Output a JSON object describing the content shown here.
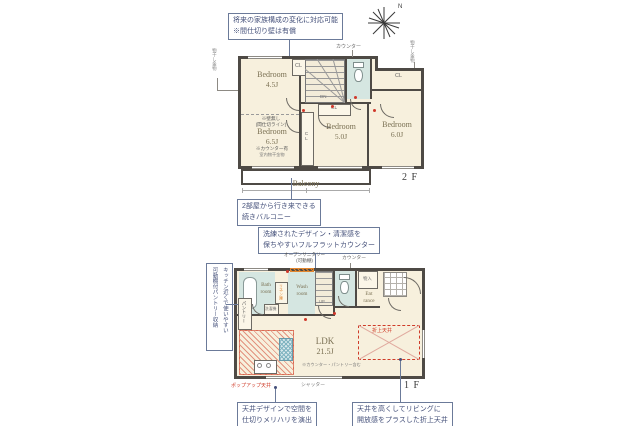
{
  "annotations": {
    "future_note": {
      "line1": "将来の家族構成の変化に対応可能",
      "line2": "※間仕切り壁は有償"
    },
    "balcony_note": {
      "line1": "2部屋から行き来できる",
      "line2": "続きバルコニー"
    },
    "counter_note": {
      "line1": "洗練されたデザイン・清潔感を",
      "line2": "保ちやすいフルフラットカウンター"
    },
    "pantry_note": {
      "line1": "キッチン近くで使いやすい",
      "line2": "可動棚付パントリー収納"
    },
    "ceiling_zone_note": {
      "line1": "天井デザインで空間を",
      "line2": "仕切りメリハリを演出"
    },
    "raised_ceiling_note": {
      "line1": "天井を高くしてリビングに",
      "line2": "開放感をプラスした折上天井"
    }
  },
  "compass": {
    "north": "N"
  },
  "floor2": {
    "label": "2 F",
    "bedroom_45": {
      "name": "Bedroom",
      "size": "4.5J"
    },
    "partition_note": {
      "line1": "※壁無し",
      "line2": "(間仕切ライン)"
    },
    "bedroom_65": {
      "name": "Bedroom",
      "size": "6.5J",
      "counter_note": "※カウンター有",
      "hoshi_note": "室内物干金物"
    },
    "bedroom_50": {
      "name": "Bedroom",
      "size": "5.0J"
    },
    "bedroom_60": {
      "name": "Bedroom",
      "size": "6.0J"
    },
    "balcony": "Balcony",
    "counter_label": "カウンター",
    "cl": "CL",
    "dn": "DN",
    "laundry_left": "物干し金物",
    "laundry_right": "物干し金物"
  },
  "floor1": {
    "label": "1 F",
    "bath": {
      "line1": "Bath",
      "line2": "room"
    },
    "wash": {
      "line1": "Wash",
      "line2": "room"
    },
    "linen": "リネン庫",
    "washer": "洗濯機",
    "sanitary_label": {
      "line1": "オープンサニタリー",
      "line2": "(可動棚)"
    },
    "toilet_counter_label": "カウンター",
    "storage": "物入",
    "entrance": {
      "line1": "Ent",
      "line2": "rance"
    },
    "up": "UP",
    "pantry": "パントリー",
    "ldk": {
      "name": "LDK",
      "size": "21.5J",
      "note": "※カウンター・パントリー含む"
    },
    "raised_ceiling": "折上天井",
    "popup_ceiling": "ポップアップ天井",
    "shutter": "シャッター"
  },
  "colors": {
    "accent_red": "#cf3b28",
    "accent_orange": "#e2862f",
    "note_blue": "#44507a",
    "wall": "#4e4a45"
  }
}
